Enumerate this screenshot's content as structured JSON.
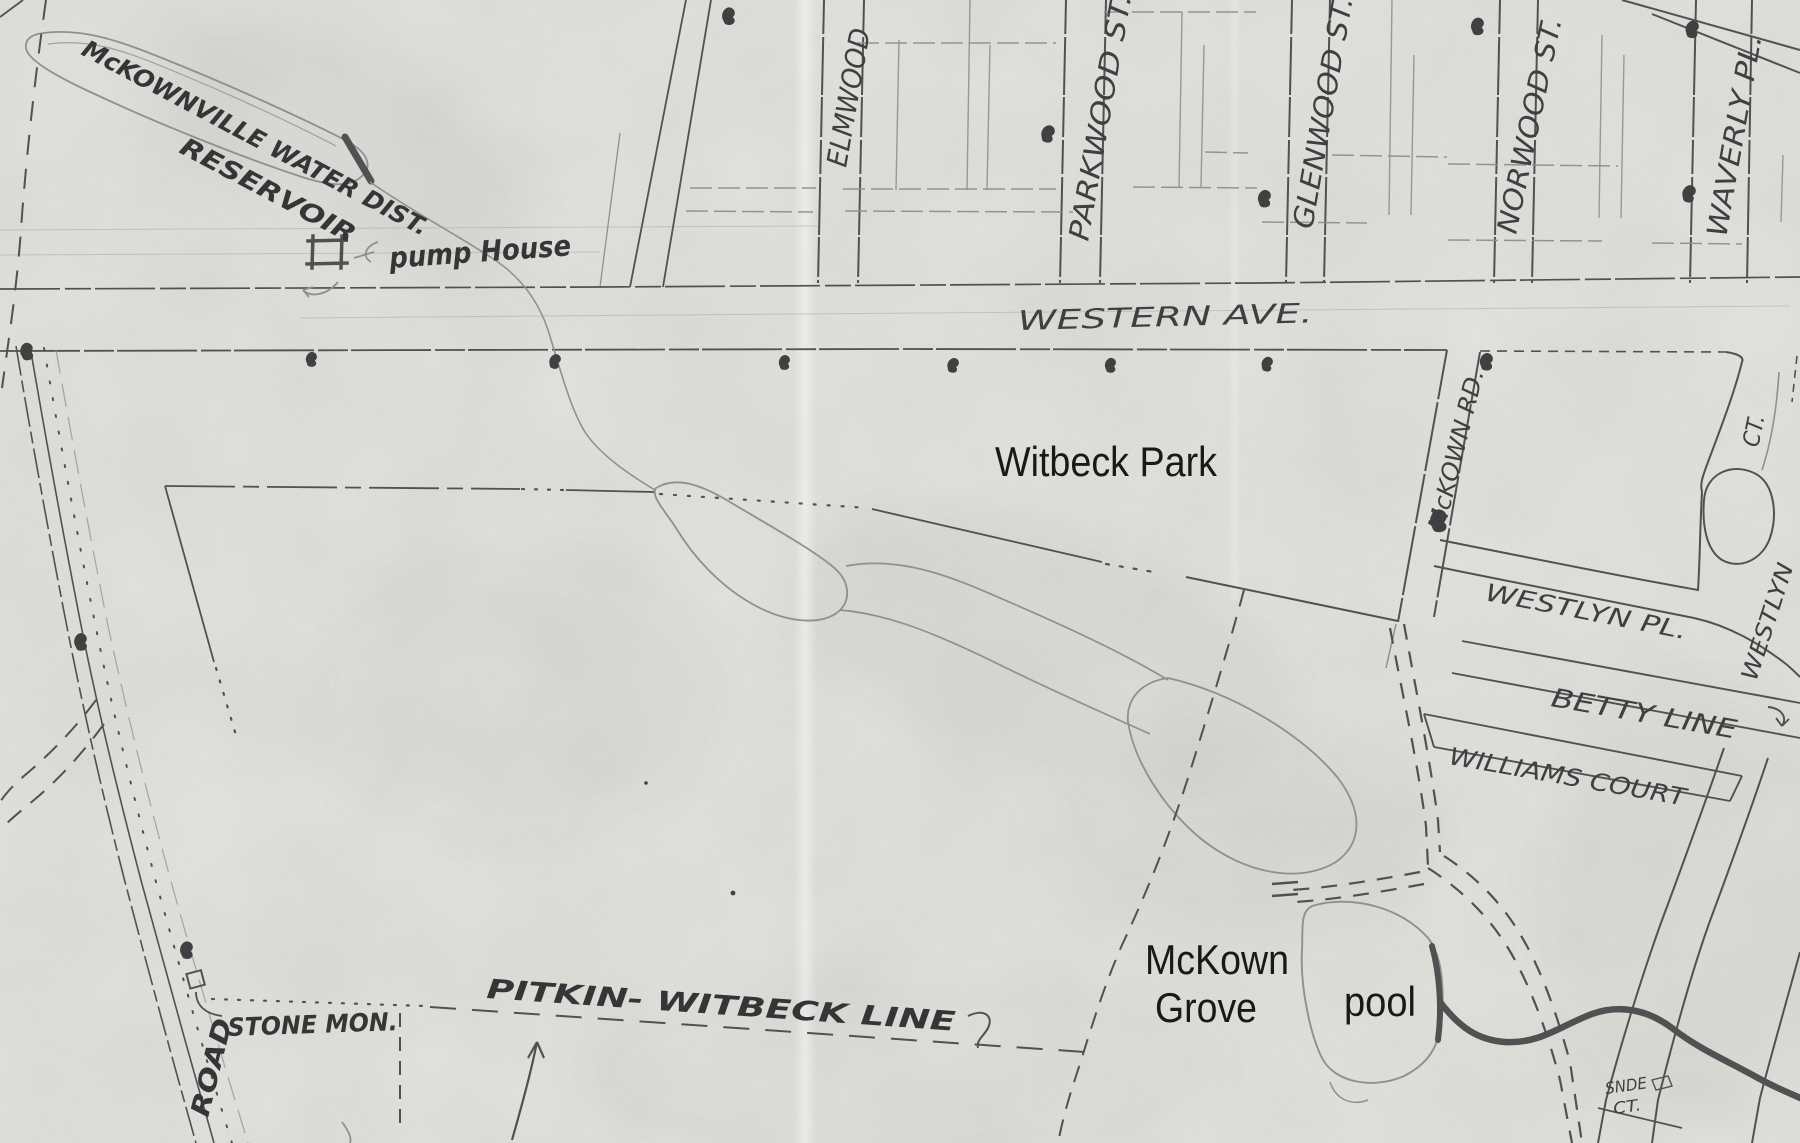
{
  "map": {
    "description": "Scanned hand-drawn street map of the McKownville / Witbeck Park area with typed annotations",
    "labels": {
      "reservoir_line1": "McKOWNVILLE WATER DIST.",
      "reservoir_line2": "RESERVOIR",
      "pump_house": "pump House",
      "western_ave": "WESTERN AVE.",
      "street_elmwood": "ELMWOOD",
      "street_parkwood": "PARKWOOD ST.",
      "street_glenwood": "GLENWOOD ST.",
      "street_norwood": "NORWOOD ST.",
      "street_waverly": "WAVERLY PL.",
      "mckown_rd": "McKOWN RD.",
      "westlyn_pl": "WESTLYN PL.",
      "westlyn_ct": "CT.",
      "westlyn_road": "WESTLYN",
      "betty_line": "BETTY LINE",
      "williams_court": "WILLIAMS COURT",
      "pitkin_witbeck": "PITKIN- WITBECK LINE",
      "stone_mon": "STONE MON.",
      "road": "ROAD",
      "snde_ct_line1": "SNDE",
      "snde_ct_line2": "CT."
    },
    "modern_labels": {
      "witbeck_park": "Witbeck Park",
      "mckown_grove_line1": "McKown",
      "mckown_grove_line2": "Grove",
      "pool": "pool"
    },
    "colors": {
      "paper": "#e9e8e4",
      "ink": "#4a4a4c",
      "ink_faint": "#8e8e8c",
      "hand_text": "#37373a",
      "modern_text": "#0d0d0d"
    }
  }
}
